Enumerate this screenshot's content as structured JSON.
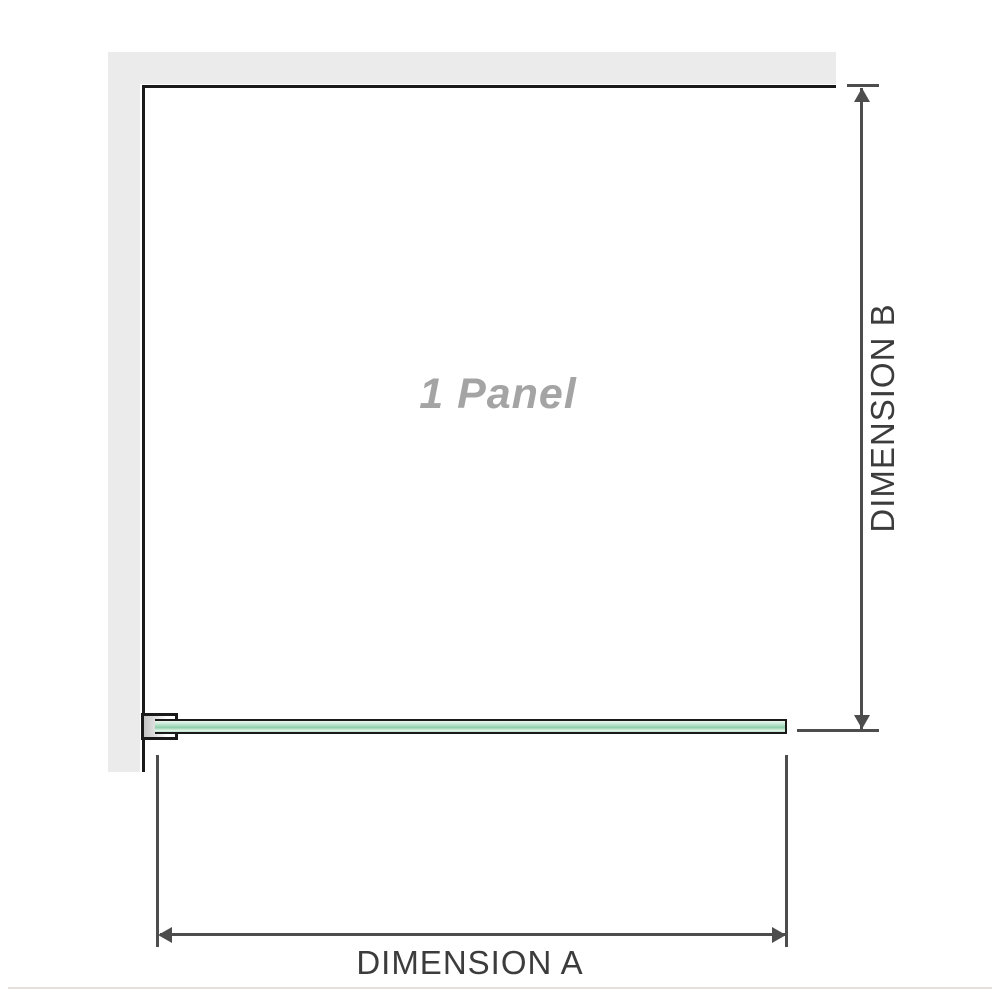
{
  "diagram": {
    "panel_label": "1 Panel",
    "dimension_a_label": "DIMENSION A",
    "dimension_b_label": "DIMENSION B"
  },
  "colors": {
    "wall": "#ebebeb",
    "outline": "#1a1a1a",
    "dimension": "#4d4d4d",
    "label_dark": "#3c3c3c",
    "label_gray": "#a4a4a4",
    "bracket_shade": "#c3c3c3",
    "glass_pale": "#eaf7ef",
    "glass_light": "#c8e9d5",
    "glass_mid": "#a5dabe",
    "glass_dark": "#8fcdaa",
    "divider": "#e3dfda"
  }
}
